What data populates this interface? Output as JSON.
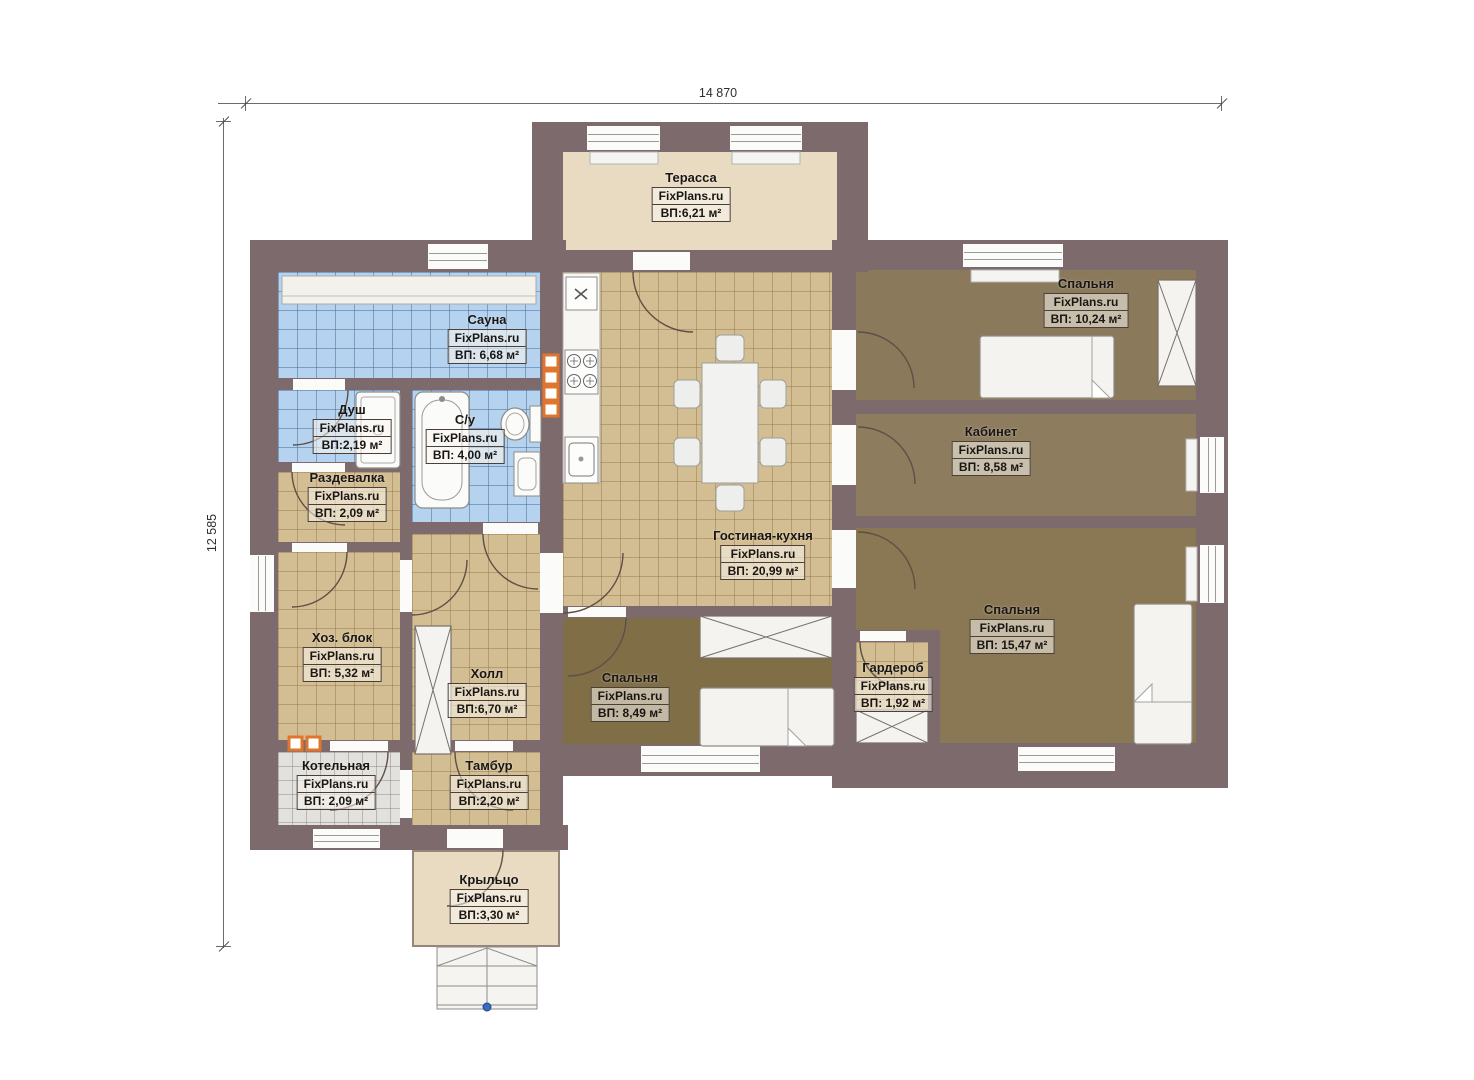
{
  "watermark": "FixPlans.ru",
  "dimensions": {
    "top": "14 870",
    "left": "12 585"
  },
  "rooms": {
    "terrace": {
      "name": "Терасса",
      "area": "ВП:6,21 м²"
    },
    "sauna": {
      "name": "Сауна",
      "area": "ВП: 6,68 м²"
    },
    "shower": {
      "name": "Душ",
      "area": "ВП:2,19 м²"
    },
    "bathroom": {
      "name": "С/у",
      "area": "ВП: 4,00 м²"
    },
    "dressing": {
      "name": "Раздевалка",
      "area": "ВП: 2,09 м²"
    },
    "utility": {
      "name": "Хоз. блок",
      "area": "ВП: 5,32 м²"
    },
    "hall": {
      "name": "Холл",
      "area": "ВП:6,70 м²"
    },
    "boiler": {
      "name": "Котельная",
      "area": "ВП: 2,09 м²"
    },
    "vestibule": {
      "name": "Тамбур",
      "area": "ВП:2,20 м²"
    },
    "porch": {
      "name": "Крыльцо",
      "area": "ВП:3,30 м²"
    },
    "living_kitchen": {
      "name": "Гостиная-кухня",
      "area": "ВП: 20,99 м²"
    },
    "bedroom1": {
      "name": "Спальня",
      "area": "ВП: 10,24 м²"
    },
    "office": {
      "name": "Кабинет",
      "area": "ВП: 8,58 м²"
    },
    "bedroom2": {
      "name": "Спальня",
      "area": "ВП: 15,47 м²"
    },
    "bedroom3": {
      "name": "Спальня",
      "area": "ВП: 8,49 м²"
    },
    "wardrobe": {
      "name": "Гардероб",
      "area": "ВП: 1,92 м²"
    }
  },
  "colors": {
    "wall": "#7d6a6c",
    "tile_beige": "#d3bd92",
    "tile_blue": "#b5d2ee",
    "tile_gray": "#e2e1dd",
    "carpet": "#8a7753",
    "terrace_floor": "#e8dbc2",
    "heater_orange": "#e0762e",
    "reference_dot_blue": "#3a6bc4"
  }
}
